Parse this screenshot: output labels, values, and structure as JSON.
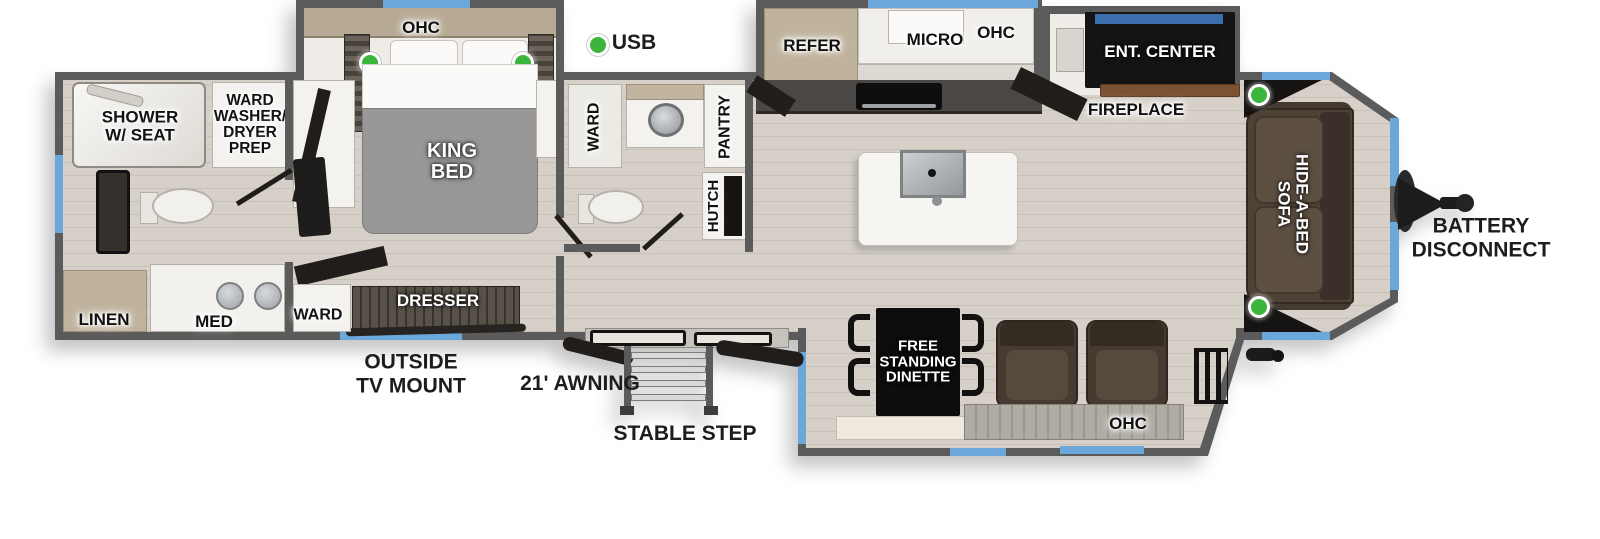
{
  "legend": {
    "usb": "USB"
  },
  "exterior": {
    "outside_tv_mount": "OUTSIDE\nTV MOUNT",
    "awning": "21' AWNING",
    "stable_step": "STABLE STEP",
    "battery_disconnect": "BATTERY\nDISCONNECT"
  },
  "rear_bath": {
    "shower": "SHOWER\nW/ SEAT",
    "ward_washer_dryer_prep": "WARD\nWASHER/\nDRYER\nPREP",
    "linen": "LINEN",
    "med": "MED"
  },
  "bedroom": {
    "ohc": "OHC",
    "king_bed": "KING\nBED",
    "dresser": "DRESSER",
    "ward": "WARD"
  },
  "mid_bath": {
    "ward": "WARD",
    "pantry": "PANTRY",
    "hutch": "HUTCH"
  },
  "kitchen": {
    "refer": "REFER",
    "micro": "MICRO",
    "ohc": "OHC"
  },
  "living": {
    "ent_center": "ENT. CENTER",
    "fireplace": "FIREPLACE",
    "hide_a_bed_sofa": "HIDE-A-BED\nSOFA",
    "free_standing_dinette": "FREE\nSTANDING\nDINETTE",
    "ohc": "OHC"
  },
  "colors": {
    "wall": "#5b5b5b",
    "floor": "#d3ccc4",
    "window": "#6ba7d9",
    "usb_dot": "#3cb53c",
    "sofa_brown": "#4e4237",
    "cabinet_white": "#f4f2ef",
    "accent_black": "#151515"
  }
}
